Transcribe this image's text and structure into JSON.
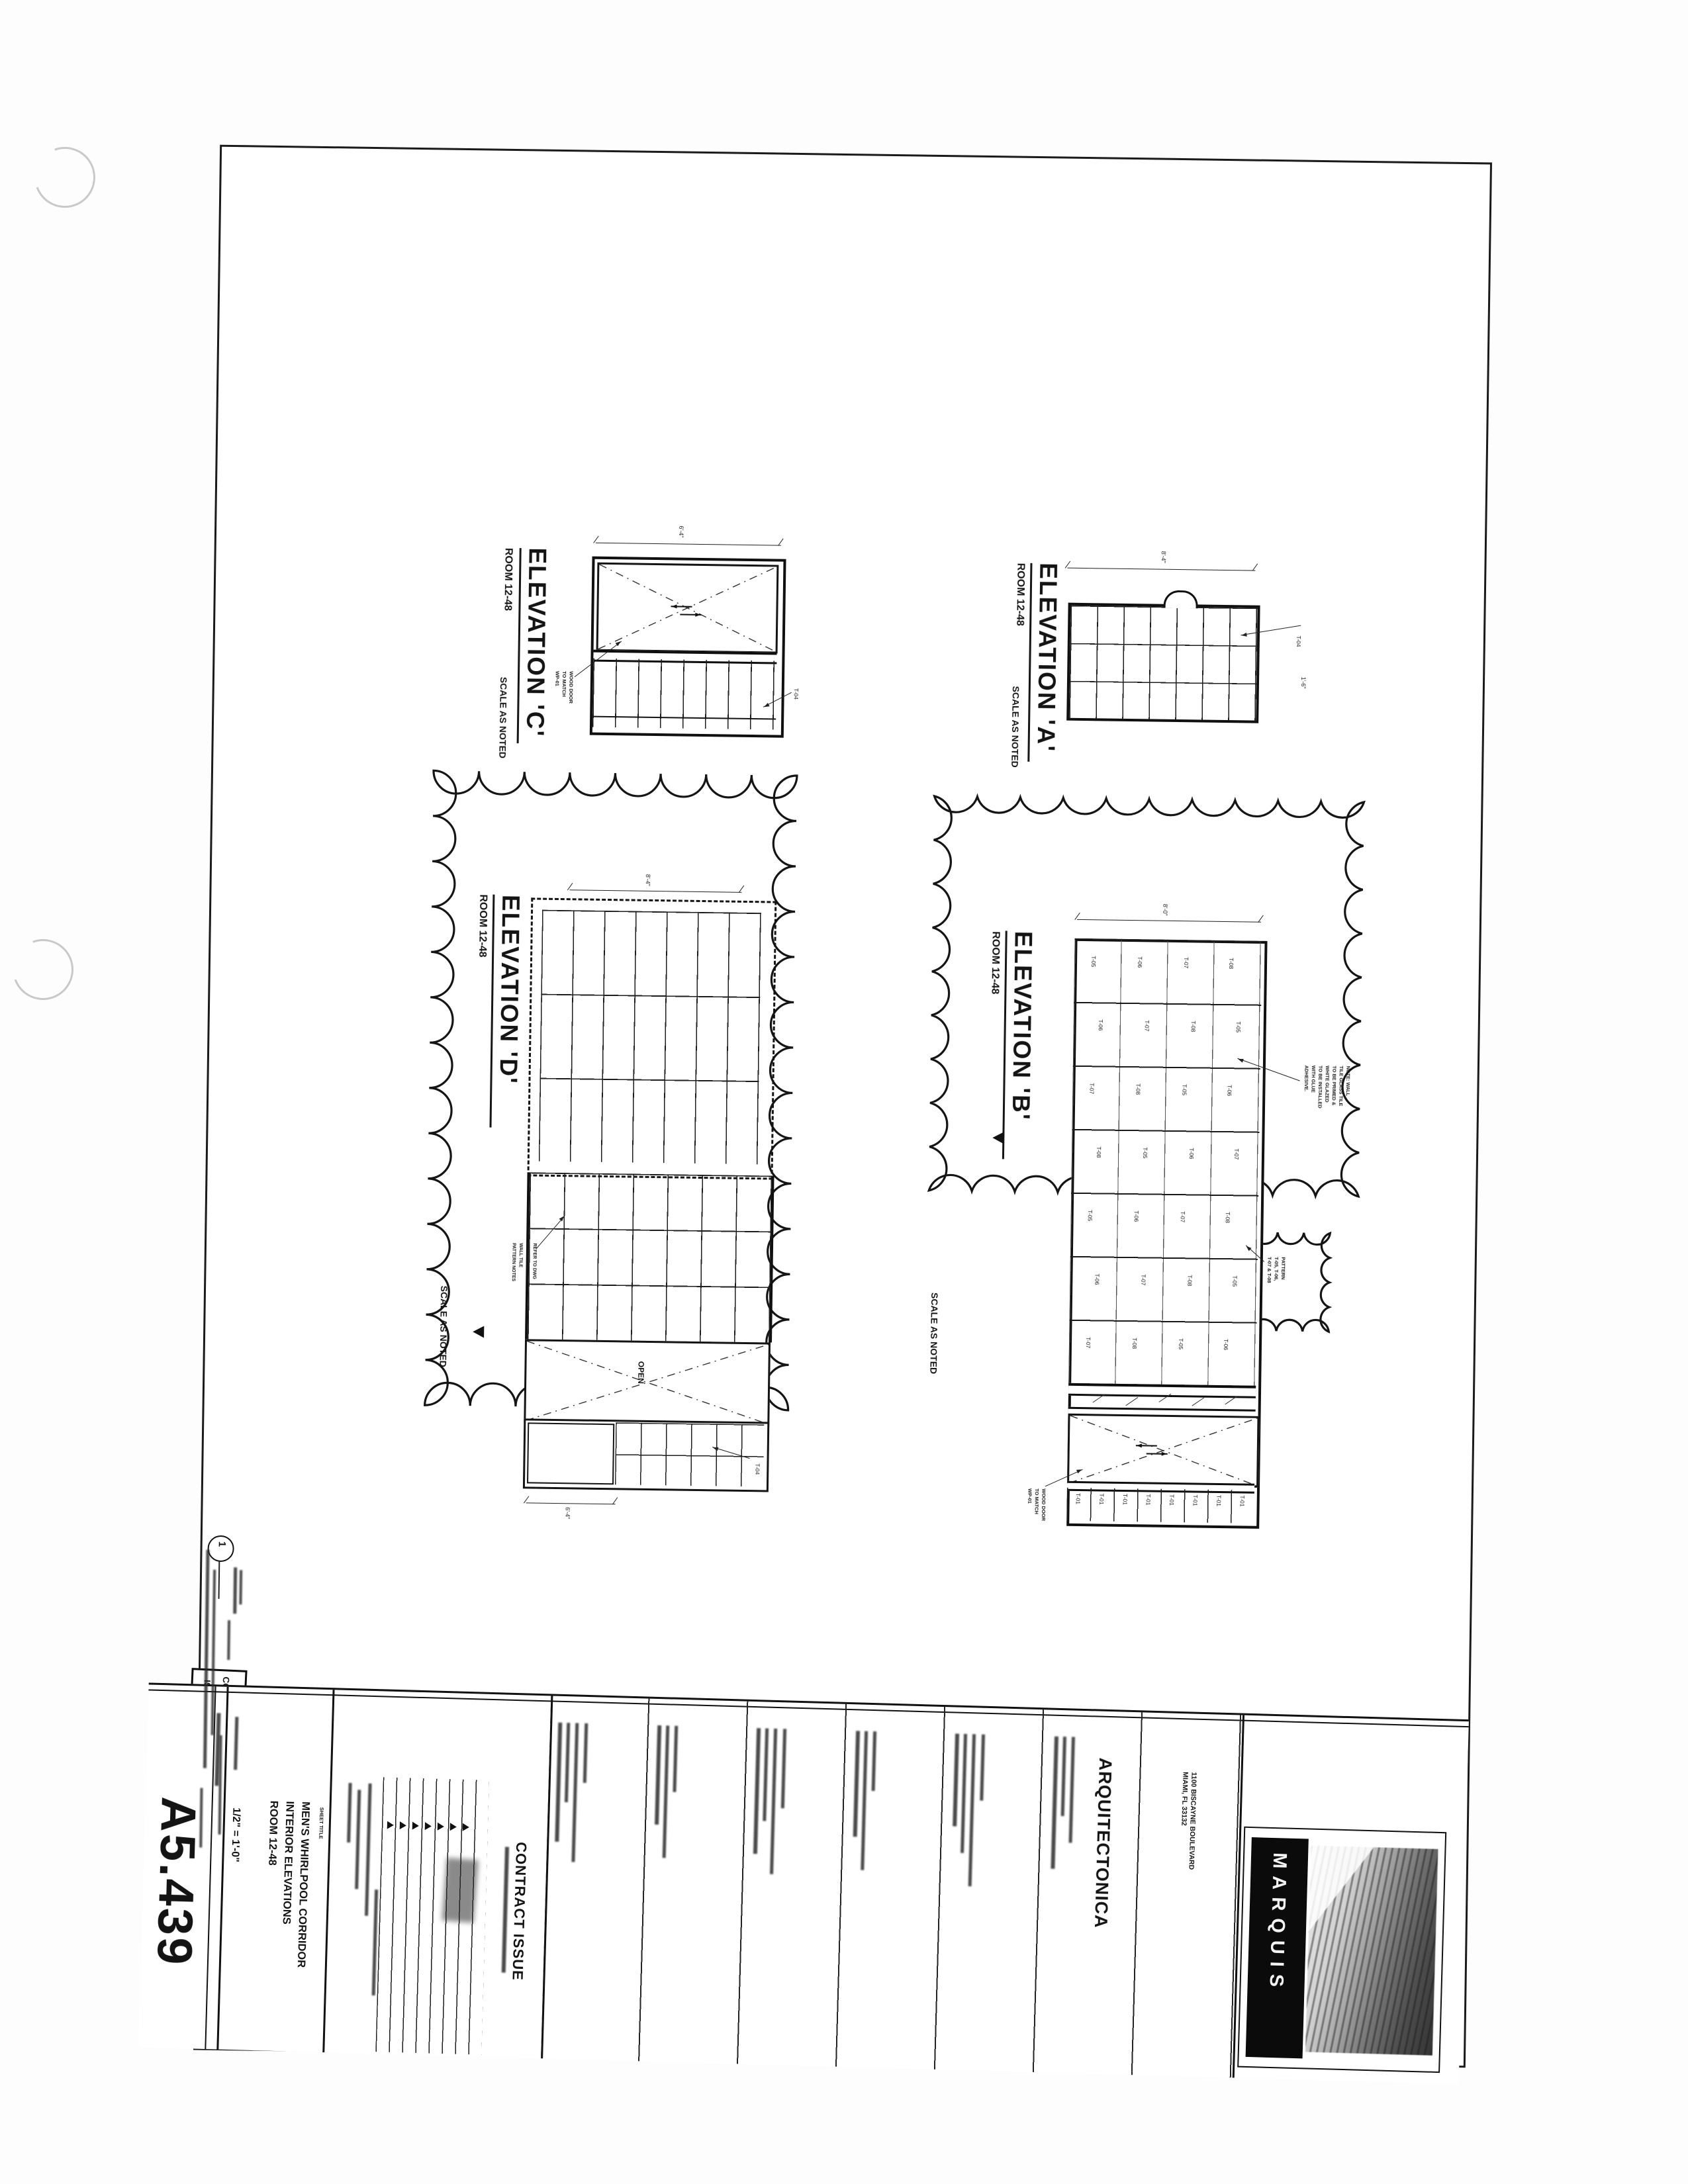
{
  "elevations": {
    "c": {
      "title": "ELEVATION 'C'",
      "room": "ROOM 12-48",
      "scale_note": "SCALE AS NOTED",
      "dim_top": "6'-4\"",
      "tile_label": "T-04",
      "door_note_lines": [
        "WOOD DOOR",
        "TO MATCH",
        "WP-01"
      ]
    },
    "a": {
      "title": "ELEVATION 'A'",
      "room": "ROOM 12-48",
      "scale_note": "SCALE AS NOTED",
      "dim_top": "8'-4\"",
      "tile_label": "T-04",
      "dim_right": "1'-6\""
    },
    "d": {
      "title": "ELEVATION 'D'",
      "room": "ROOM 12-48",
      "scale_note": "SCALE AS NOTED",
      "dim_top": "8'-4\"",
      "dim_bottom": "6'-4\"",
      "tile_label": "T-04",
      "open_label": "OPEN",
      "refer_note_lines": [
        "REFER TO DWG",
        "A5-448 FOR",
        "WALL TILE",
        "PATTERN NOTES"
      ]
    },
    "b": {
      "title": "ELEVATION 'B'",
      "room": "ROOM 12-48",
      "scale_note": "SCALE AS NOTED",
      "dim_top": "8'-0\"",
      "tile_labels": [
        "T-05",
        "T-06",
        "T-07",
        "T-08",
        "T-06",
        "T-07",
        "T-08",
        "T-05",
        "T-07",
        "T-08",
        "T-05",
        "T-06",
        "T-08",
        "T-05",
        "T-06",
        "T-07",
        "T-05",
        "T-06",
        "T-07",
        "T-08",
        "T-06",
        "T-07",
        "T-08",
        "T-05",
        "T-07",
        "T-08",
        "T-05",
        "T-06"
      ],
      "bottom_tile_labels": [
        "T-01",
        "T-01",
        "T-01",
        "T-01",
        "T-01",
        "T-01",
        "T-01",
        "T-01"
      ],
      "cloud_note_lines": [
        "NOTE: WALL",
        "TILE GLASS TILE",
        "TO BE PRIMED &",
        "WHITE GLAZED",
        "TO BE INSTALLED",
        "WITH GLUE",
        "ADHESIVE."
      ],
      "pattern_note_lines": [
        "PATTERN",
        "T-05, T-06,",
        "T-07 & T-08"
      ],
      "door_note_lines": [
        "WOOD DOOR",
        "TO MATCH",
        "WP-01"
      ]
    }
  },
  "stamp": {
    "line1": "CONFORMITY SET",
    "line2": "ISSUED 01/31/08"
  },
  "revision_marker": "1",
  "title_block": {
    "sheet_number": "A5.439",
    "scale_value": "1/2\" = 1'-0\"",
    "title_label": "SHEET TITLE",
    "title_lines": [
      "MEN'S WHIRLPOOL CORRIDOR",
      "INTERIOR ELEVATIONS",
      "ROOM 12-48"
    ],
    "issue": "CONTRACT ISSUE",
    "firm": "ARQUITECTONICA",
    "address_lines": [
      "1100 BISCAYNE BOULEVARD",
      "MIAMI, FL 33132"
    ],
    "logo": "MARQUIS"
  }
}
